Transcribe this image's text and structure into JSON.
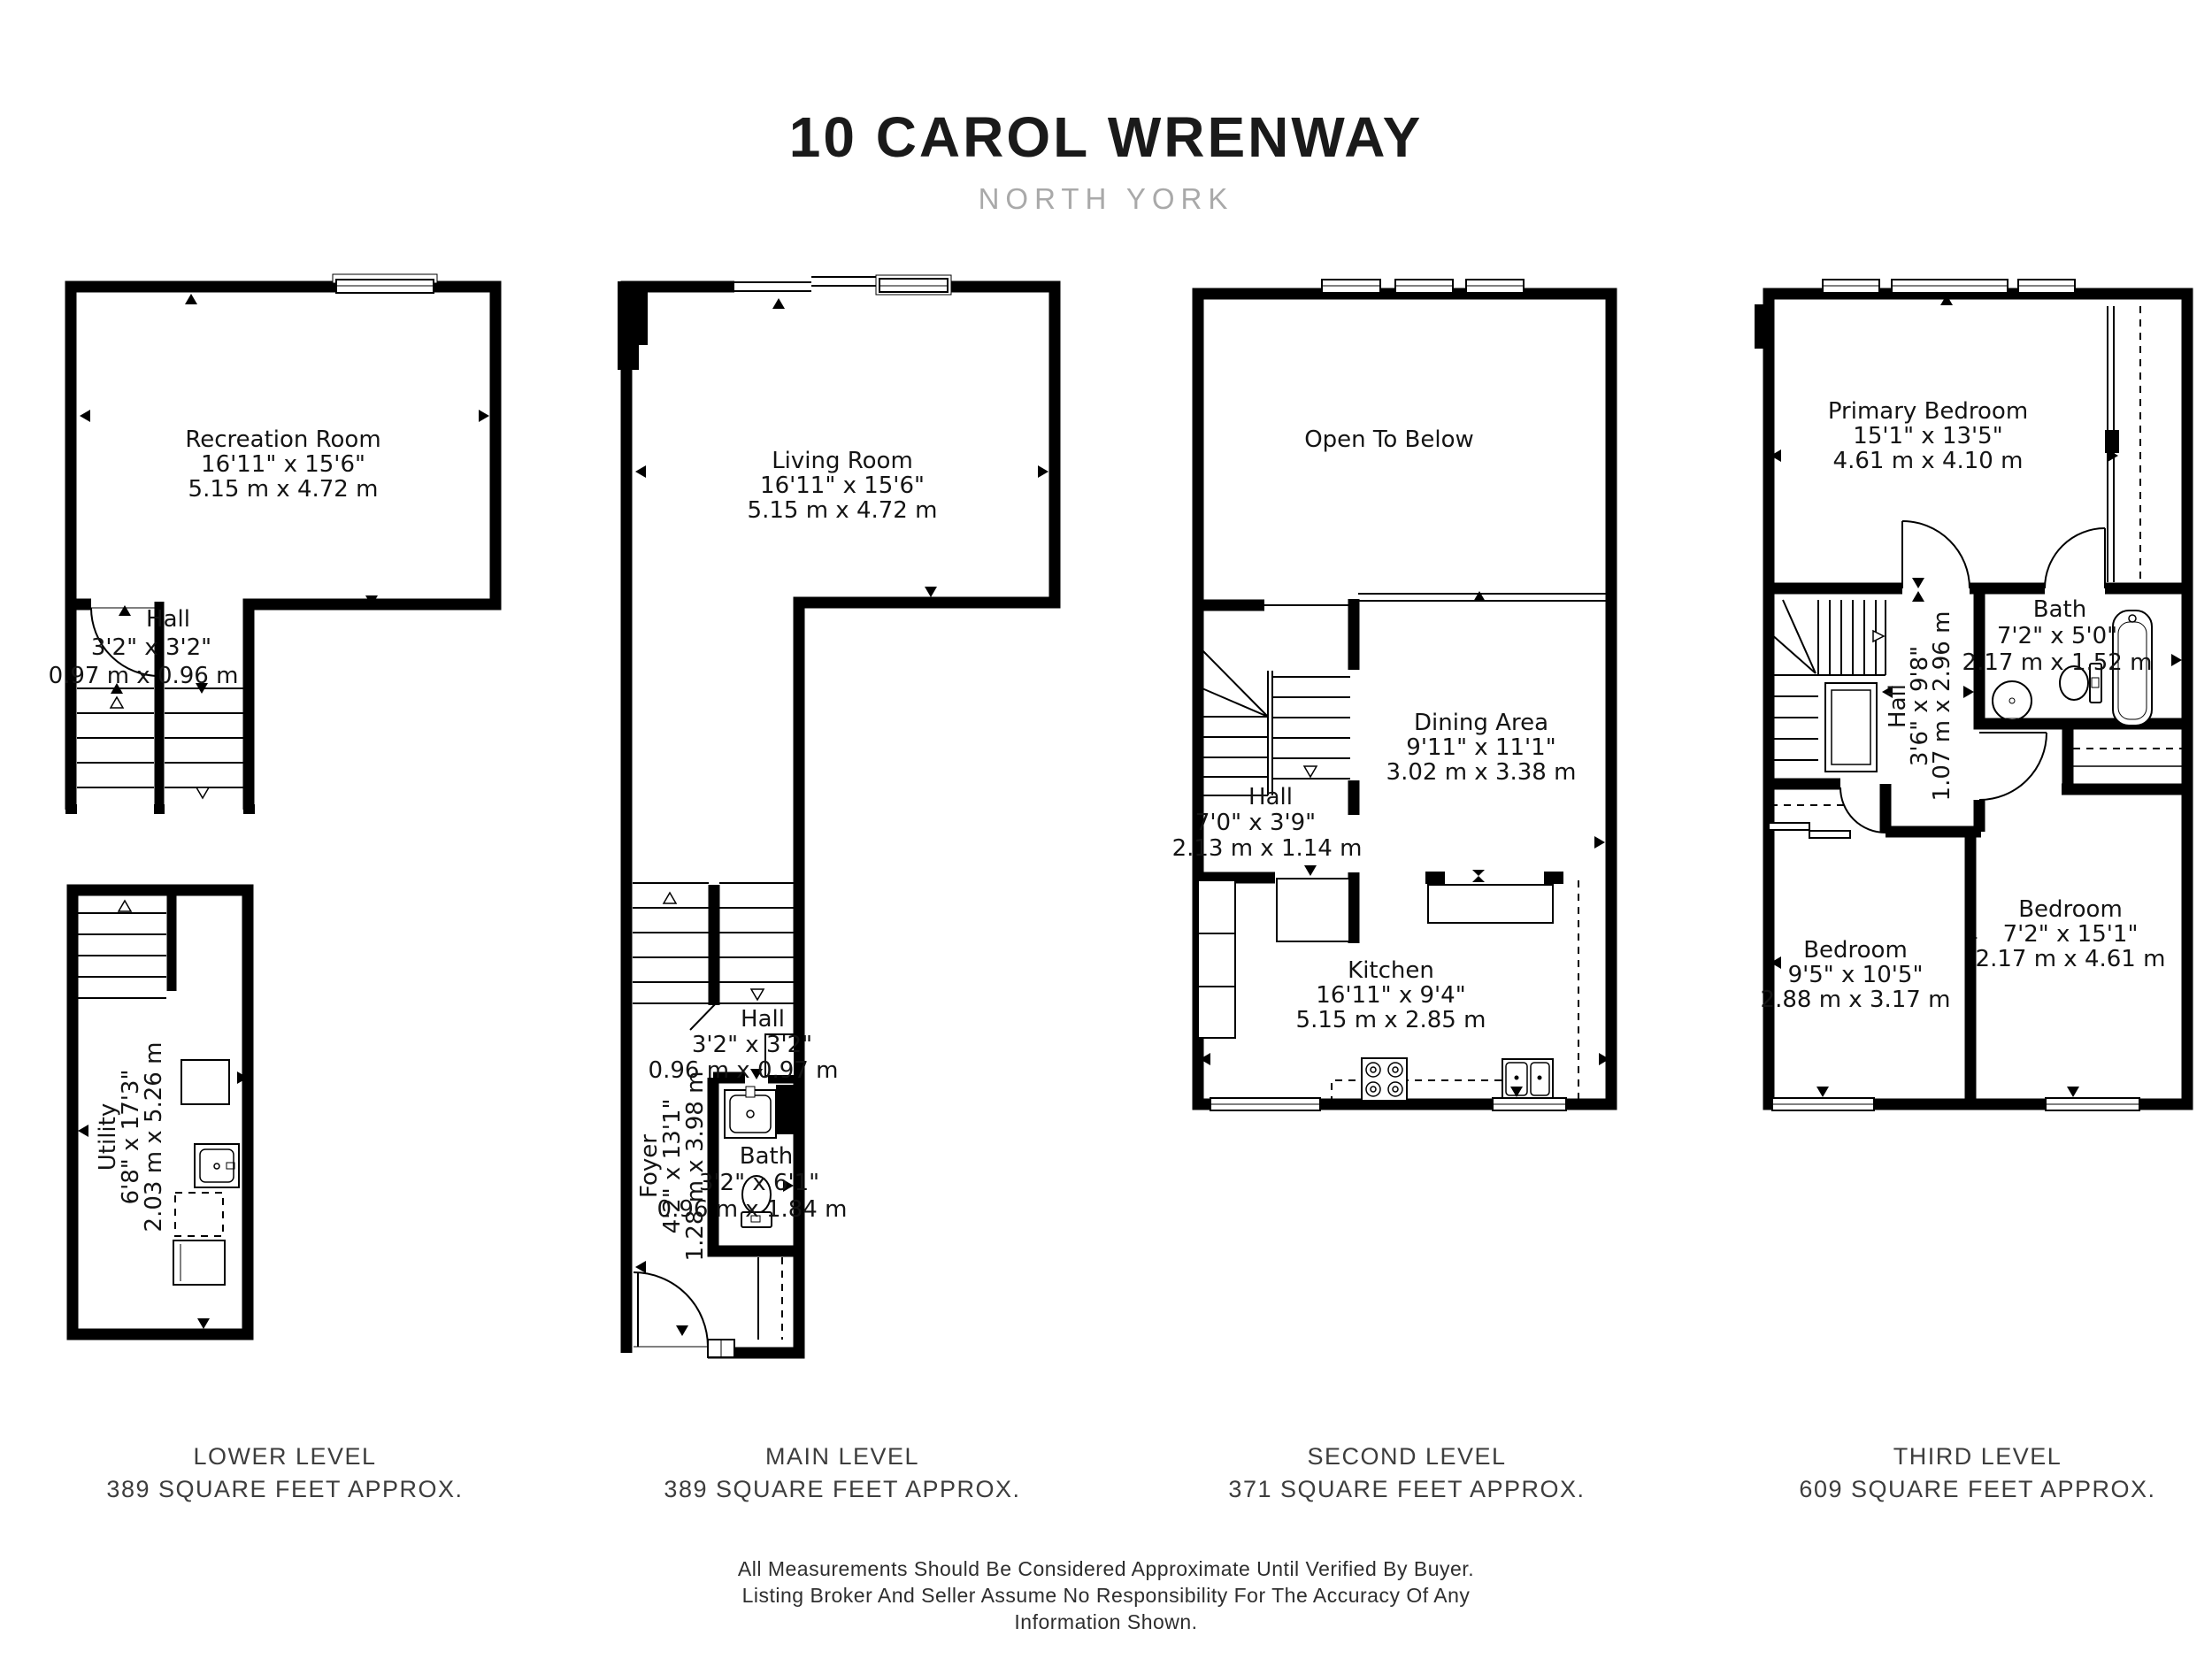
{
  "header": {
    "title": "10 CAROL WRENWAY",
    "subtitle": "NORTH YORK"
  },
  "levels": [
    {
      "name": "LOWER LEVEL",
      "area": "389 SQUARE FEET APPROX."
    },
    {
      "name": "MAIN LEVEL",
      "area": "389 SQUARE FEET APPROX."
    },
    {
      "name": "SECOND LEVEL",
      "area": "371 SQUARE FEET APPROX."
    },
    {
      "name": "THIRD LEVEL",
      "area": "609 SQUARE FEET APPROX."
    }
  ],
  "rooms": {
    "recreation": {
      "name": "Recreation Room",
      "imperial": "16'11\" x 15'6\"",
      "metric": "5.15 m x 4.72 m"
    },
    "hall_lower": {
      "name": "Hall",
      "imperial": "3'2\" x 3'2\"",
      "metric": "0.97 m x 0.96 m"
    },
    "utility": {
      "name": "Utility",
      "imperial": "6'8\" x 17'3\"",
      "metric": "2.03 m x 5.26 m"
    },
    "living": {
      "name": "Living Room",
      "imperial": "16'11\" x 15'6\"",
      "metric": "5.15 m x 4.72 m"
    },
    "hall_main": {
      "name": "Hall",
      "imperial": "3'2\" x 3'2\"",
      "metric": "0.96 m x 0.97 m"
    },
    "foyer": {
      "name": "Foyer",
      "imperial": "4'2\" x 13'1\"",
      "metric": "1.28 m x 3.98 m"
    },
    "bath_main": {
      "name": "Bath",
      "imperial": "3'2\" x 6'1\"",
      "metric": "0.96 m x 1.84 m"
    },
    "open_to_below": {
      "name": "Open To Below"
    },
    "dining": {
      "name": "Dining Area",
      "imperial": "9'11\" x 11'1\"",
      "metric": "3.02 m x 3.38 m"
    },
    "hall_second": {
      "name": "Hall",
      "imperial": "7'0\" x 3'9\"",
      "metric": "2.13 m x 1.14 m"
    },
    "kitchen": {
      "name": "Kitchen",
      "imperial": "16'11\" x 9'4\"",
      "metric": "5.15 m x 2.85 m"
    },
    "primary": {
      "name": "Primary Bedroom",
      "imperial": "15'1\" x 13'5\"",
      "metric": "4.61 m x 4.10 m"
    },
    "bath_third": {
      "name": "Bath",
      "imperial": "7'2\" x 5'0\"",
      "metric": "2.17 m x 1.52 m"
    },
    "hall_third": {
      "name": "Hall",
      "imperial": "3'6\" x 9'8\"",
      "metric": "1.07 m x 2.96 m"
    },
    "bedroom_left": {
      "name": "Bedroom",
      "imperial": "9'5\" x 10'5\"",
      "metric": "2.88 m x 3.17 m"
    },
    "bedroom_right": {
      "name": "Bedroom",
      "imperial": "7'2\" x 15'1\"",
      "metric": "2.17 m x 4.61 m"
    }
  },
  "disclaimer": {
    "line1": "All Measurements Should Be Considered Approximate Until Verified By Buyer.",
    "line2": "Listing Broker And Seller Assume No Responsibility For The Accuracy Of Any",
    "line3": "Information Shown."
  }
}
